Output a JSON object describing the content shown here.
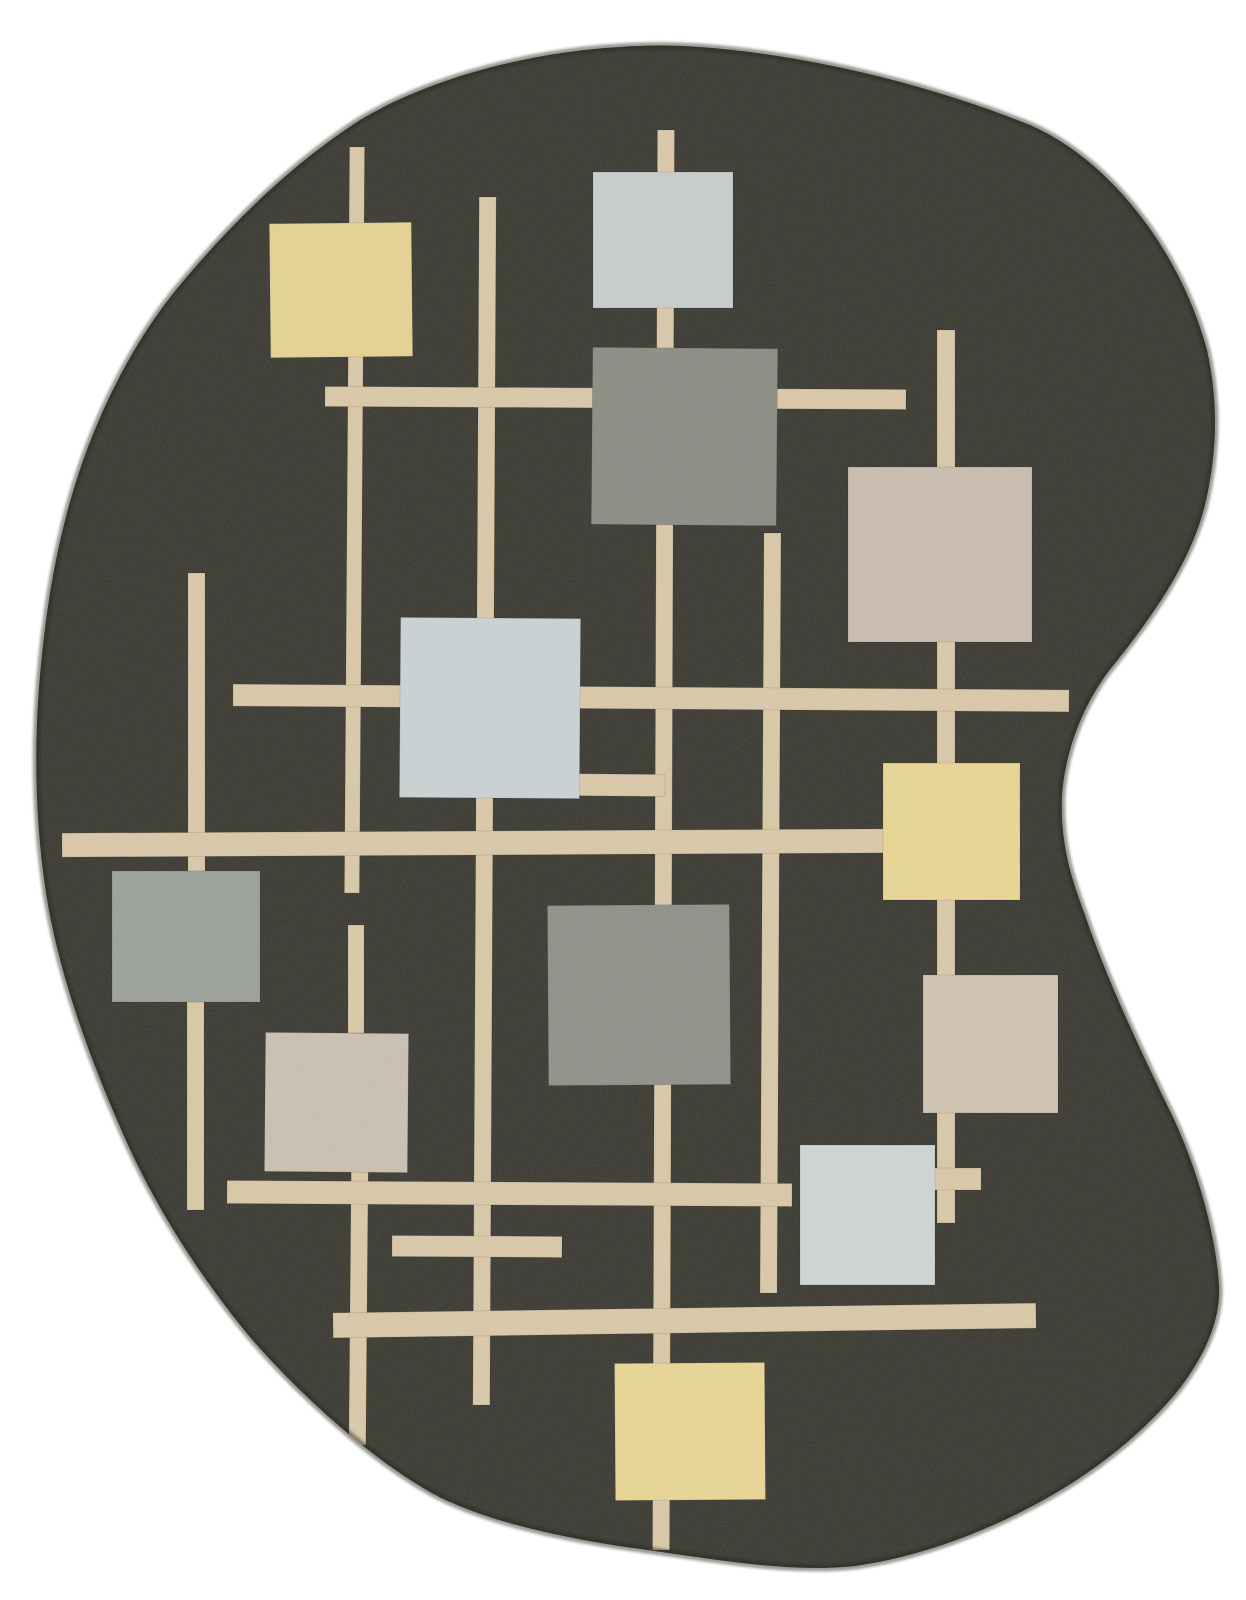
{
  "image": {
    "kind": "product-photo",
    "subject": "kidney-shaped hand-tufted area rug with geometric grid-and-squares pattern on charcoal ground",
    "width": 1246,
    "height": 1600
  },
  "rug": {
    "colors": {
      "background": "#ffffff",
      "pile": "#3a3933",
      "pile_edge": "#23221c",
      "line": "#d7c7a7",
      "texture_fleck": "#cfc2a6"
    },
    "outline_path": "M 700 47 C 810 55 930 85 1030 125 C 1110 160 1180 250 1207 350 C 1218 400 1218 450 1205 505 C 1190 565 1150 620 1108 672 C 1080 710 1065 755 1062 795 C 1060 845 1072 880 1085 915 C 1105 975 1140 1050 1172 1115 C 1198 1170 1216 1235 1219 1285 C 1221 1320 1205 1355 1180 1388 C 1145 1432 1095 1472 1040 1502 C 985 1532 920 1557 855 1566 C 790 1573 720 1560 640 1549 C 560 1538 480 1520 430 1492 C 370 1458 300 1395 250 1337 C 205 1283 160 1215 128 1145 C 95 1072 62 985 48 905 C 36 835 33 755 40 675 C 46 610 55 550 75 485 C 95 420 130 345 180 285 C 230 225 290 165 360 120 C 430 78 530 52 620 47 C 648 45 672 45 700 47 Z",
    "grid_lines": [
      {
        "name": "v-left-upper",
        "x": 188,
        "y": 573,
        "w": 17,
        "h": 298,
        "rotate": 0
      },
      {
        "name": "v-left-lower",
        "x": 187,
        "y": 1002,
        "w": 17,
        "h": 208,
        "rotate": 0
      },
      {
        "name": "v-1",
        "x": 347,
        "y": 147,
        "w": 15,
        "h": 746,
        "rotate": 0.4
      },
      {
        "name": "v-1-stub",
        "x": 348,
        "y": 925,
        "w": 16,
        "h": 108,
        "rotate": 0
      },
      {
        "name": "v-1-lower",
        "x": 350,
        "y": 1172,
        "w": 17,
        "h": 273,
        "rotate": 0.5
      },
      {
        "name": "v-2",
        "x": 476,
        "y": 197,
        "w": 17,
        "h": 1208,
        "rotate": 0.3
      },
      {
        "name": "v-3",
        "x": 655,
        "y": 130,
        "w": 17,
        "h": 1420,
        "rotate": 0.2
      },
      {
        "name": "v-4",
        "x": 937,
        "y": 330,
        "w": 18,
        "h": 893,
        "rotate": 0
      },
      {
        "name": "v-5",
        "x": 762,
        "y": 533,
        "w": 17,
        "h": 760,
        "rotate": 0.3
      },
      {
        "name": "h-top",
        "x": 325,
        "y": 388,
        "w": 581,
        "h": 20,
        "rotate": 0.3
      },
      {
        "name": "h-mid",
        "x": 233,
        "y": 687,
        "w": 836,
        "h": 22,
        "rotate": 0.4
      },
      {
        "name": "h-sq5-stub",
        "x": 555,
        "y": 774,
        "w": 110,
        "h": 22,
        "rotate": 0.5
      },
      {
        "name": "h-long",
        "x": 62,
        "y": 831,
        "w": 824,
        "h": 24,
        "rotate": -0.3
      },
      {
        "name": "h-lower",
        "x": 227,
        "y": 1182,
        "w": 565,
        "h": 23,
        "rotate": 0.3
      },
      {
        "name": "h-lower-stub",
        "x": 392,
        "y": 1236,
        "w": 170,
        "h": 21,
        "rotate": 0.3
      },
      {
        "name": "h-bottom",
        "x": 333,
        "y": 1308,
        "w": 703,
        "h": 25,
        "rotate": -0.8
      },
      {
        "name": "cross-arm",
        "x": 933,
        "y": 1168,
        "w": 48,
        "h": 22,
        "rotate": 0
      }
    ],
    "squares": [
      {
        "name": "yellow-top-left",
        "x": 270,
        "y": 223,
        "w": 142,
        "h": 134,
        "color": "#e4d092",
        "rotate": -0.6
      },
      {
        "name": "bluegray-top",
        "x": 593,
        "y": 172,
        "w": 140,
        "h": 136,
        "color": "#c6cccb",
        "rotate": 0
      },
      {
        "name": "gray-upper",
        "x": 592,
        "y": 348,
        "w": 185,
        "h": 177,
        "color": "#8b8b85",
        "rotate": 0.5
      },
      {
        "name": "taupe-right-upper",
        "x": 848,
        "y": 467,
        "w": 184,
        "h": 175,
        "color": "#c7bcae",
        "rotate": 0
      },
      {
        "name": "bluegray-center-left",
        "x": 400,
        "y": 618,
        "w": 180,
        "h": 180,
        "color": "#c8d0d2",
        "rotate": 0.4
      },
      {
        "name": "yellow-right",
        "x": 883,
        "y": 763,
        "w": 137,
        "h": 137,
        "color": "#e6d494",
        "rotate": 0
      },
      {
        "name": "graygreen-left",
        "x": 112,
        "y": 871,
        "w": 148,
        "h": 131,
        "color": "#9aa099",
        "rotate": 0
      },
      {
        "name": "gray-center",
        "x": 548,
        "y": 905,
        "w": 182,
        "h": 180,
        "color": "#8f8f89",
        "rotate": -0.4
      },
      {
        "name": "taupe-right-lower",
        "x": 923,
        "y": 975,
        "w": 135,
        "h": 138,
        "color": "#cdc2b0",
        "rotate": 0
      },
      {
        "name": "taupe-left-lower",
        "x": 265,
        "y": 1033,
        "w": 143,
        "h": 139,
        "color": "#c9bfb1",
        "rotate": 0.5
      },
      {
        "name": "bluegray-lower",
        "x": 800,
        "y": 1145,
        "w": 135,
        "h": 140,
        "color": "#ccd3d3",
        "rotate": 0
      },
      {
        "name": "yellow-bottom",
        "x": 615,
        "y": 1363,
        "w": 150,
        "h": 137,
        "color": "#e6d494",
        "rotate": -0.4
      }
    ]
  }
}
